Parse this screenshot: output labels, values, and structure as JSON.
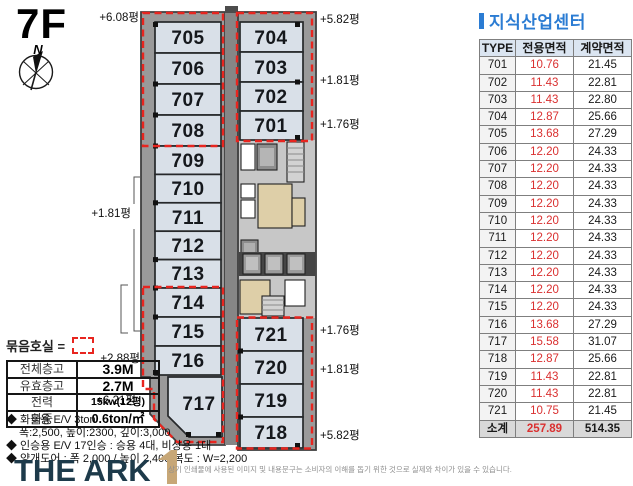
{
  "floor_label": "7F",
  "compass": {
    "north": "N"
  },
  "plan": {
    "units": [
      "705",
      "706",
      "707",
      "708",
      "709",
      "710",
      "711",
      "712",
      "713",
      "714",
      "715",
      "716",
      "717",
      "704",
      "703",
      "702",
      "701",
      "721",
      "720",
      "719",
      "718"
    ],
    "annotations": {
      "left": [
        "+6.08평",
        "+1.81평",
        "+2.88평",
        "+6.21평"
      ],
      "right": [
        "+5.82평",
        "+1.81평",
        "+1.76평",
        "+1.76평",
        "+1.81평",
        "+5.82평"
      ]
    }
  },
  "legend": {
    "label": "묶음호실 ="
  },
  "spec": {
    "rows": [
      {
        "label": "전체층고",
        "value": "3.9M"
      },
      {
        "label": "유효층고",
        "value": "2.7M"
      },
      {
        "label": "전력",
        "value": "15kw(12평)"
      },
      {
        "label": "하중",
        "value": "0.6ton/㎡"
      }
    ]
  },
  "notes": [
    "◆ 화물용 E/V 3ton",
    "폭:2,500, 높이:2300, 깊이:3,000",
    "◆ 인승용 E/V 17인승 : 승용 4대, 비상용 1대",
    "◆ 양개도어 : 폭 2,000 / 높이 2,400 복도 : W=2,200"
  ],
  "brand": {
    "name": "THE ARK"
  },
  "disclaimer": "상기 인쇄물에 사용된 이미지 및 내용문구는 소비자의 이해를 돕기 위한 것으로 실제와 차이가 있을 수 있습니다.",
  "panel": {
    "title": "지식산업센터",
    "headers": [
      "TYPE",
      "전용면적",
      "계약면적"
    ],
    "rows": [
      [
        "701",
        "10.76",
        "21.45"
      ],
      [
        "702",
        "11.43",
        "22.81"
      ],
      [
        "703",
        "11.43",
        "22.80"
      ],
      [
        "704",
        "12.87",
        "25.66"
      ],
      [
        "705",
        "13.68",
        "27.29"
      ],
      [
        "706",
        "12.20",
        "24.33"
      ],
      [
        "707",
        "12.20",
        "24.33"
      ],
      [
        "708",
        "12.20",
        "24.33"
      ],
      [
        "709",
        "12.20",
        "24.33"
      ],
      [
        "710",
        "12.20",
        "24.33"
      ],
      [
        "711",
        "12.20",
        "24.33"
      ],
      [
        "712",
        "12.20",
        "24.33"
      ],
      [
        "713",
        "12.20",
        "24.33"
      ],
      [
        "714",
        "12.20",
        "24.33"
      ],
      [
        "715",
        "12.20",
        "24.33"
      ],
      [
        "716",
        "13.68",
        "27.29"
      ],
      [
        "717",
        "15.58",
        "31.07"
      ],
      [
        "718",
        "12.87",
        "25.66"
      ],
      [
        "719",
        "11.43",
        "22.81"
      ],
      [
        "720",
        "11.43",
        "22.81"
      ],
      [
        "721",
        "10.75",
        "21.45"
      ]
    ],
    "total": [
      "소계",
      "257.89",
      "514.35"
    ]
  },
  "colors": {
    "accent_blue": "#2b7cd3",
    "grouping_red": "#e8251f",
    "exclusive_area_red": "#da3030",
    "unit_fill": "#d9e0e8"
  }
}
